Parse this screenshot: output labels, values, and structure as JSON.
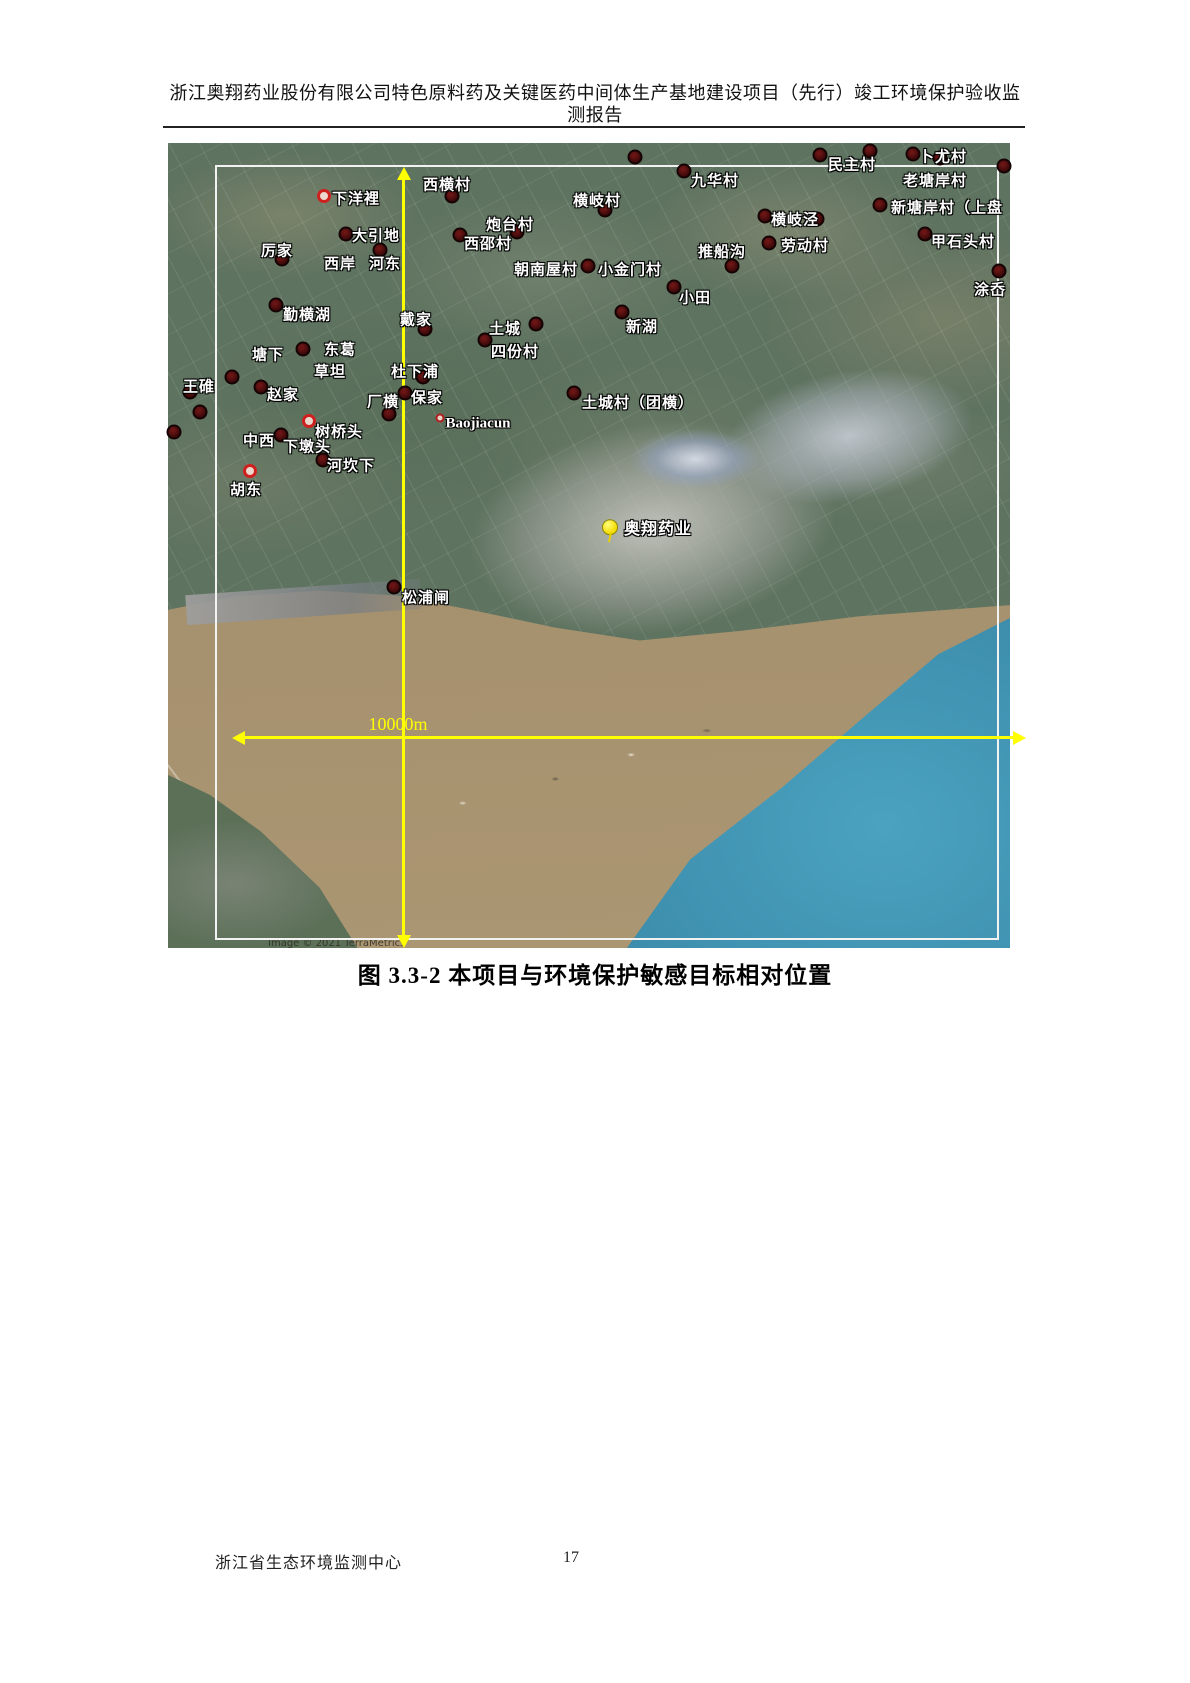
{
  "header": {
    "title_line1": "浙江奥翔药业股份有限公司特色原料药及关键医药中间体生产基地建设项目（先行）竣工环境保护验收监",
    "title_line2": "测报告"
  },
  "figure": {
    "caption": "图 3.3-2  本项目与环境保护敏感目标相对位置",
    "scale_label": "10000m",
    "attribution": "Image © 2021 TerraMetrics",
    "project": {
      "label": "奥翔药业",
      "label_x": 490,
      "label_y": 384,
      "pin_x": 442,
      "pin_y": 385
    },
    "labels": [
      {
        "text": "下洋裡",
        "x": 188,
        "y": 55
      },
      {
        "text": "西横村",
        "x": 279,
        "y": 41
      },
      {
        "text": "厉家",
        "x": 109,
        "y": 107
      },
      {
        "text": "大引地",
        "x": 208,
        "y": 92
      },
      {
        "text": "西岸",
        "x": 172,
        "y": 120
      },
      {
        "text": "河东",
        "x": 217,
        "y": 120
      },
      {
        "text": "炮台村",
        "x": 342,
        "y": 81
      },
      {
        "text": "西邵村",
        "x": 320,
        "y": 100
      },
      {
        "text": "朝南屋村",
        "x": 378,
        "y": 126
      },
      {
        "text": "小金门村",
        "x": 462,
        "y": 126
      },
      {
        "text": "横岐村",
        "x": 429,
        "y": 57
      },
      {
        "text": "九华村",
        "x": 547,
        "y": 37
      },
      {
        "text": "推船沟",
        "x": 554,
        "y": 108
      },
      {
        "text": "横岐泾",
        "x": 627,
        "y": 76
      },
      {
        "text": "劳动村",
        "x": 637,
        "y": 102
      },
      {
        "text": "民主村",
        "x": 684,
        "y": 21
      },
      {
        "text": "卜尤村",
        "x": 775,
        "y": 13
      },
      {
        "text": "老塘岸村",
        "x": 767,
        "y": 37
      },
      {
        "text": "新塘岸村（上盘",
        "x": 779,
        "y": 64
      },
      {
        "text": "甲石头村",
        "x": 795,
        "y": 98
      },
      {
        "text": "涂岙",
        "x": 822,
        "y": 146
      },
      {
        "text": "勤横湖",
        "x": 139,
        "y": 171
      },
      {
        "text": "戴家",
        "x": 248,
        "y": 176
      },
      {
        "text": "东葛",
        "x": 172,
        "y": 206
      },
      {
        "text": "塘下",
        "x": 100,
        "y": 211
      },
      {
        "text": "草坦",
        "x": 162,
        "y": 228
      },
      {
        "text": "杜下浦",
        "x": 247,
        "y": 228
      },
      {
        "text": "土城",
        "x": 337,
        "y": 185
      },
      {
        "text": "四份村",
        "x": 347,
        "y": 208
      },
      {
        "text": "王碓",
        "x": 31,
        "y": 243
      },
      {
        "text": "赵家",
        "x": 115,
        "y": 251
      },
      {
        "text": "厂横",
        "x": 215,
        "y": 258
      },
      {
        "text": "保家",
        "x": 259,
        "y": 254
      },
      {
        "text": "Baojiacun",
        "x": 310,
        "y": 281,
        "latin": true
      },
      {
        "text": "树桥头",
        "x": 171,
        "y": 288
      },
      {
        "text": "中西",
        "x": 91,
        "y": 297
      },
      {
        "text": "下墩头",
        "x": 139,
        "y": 303
      },
      {
        "text": "河坎下",
        "x": 183,
        "y": 322
      },
      {
        "text": "胡东",
        "x": 78,
        "y": 346
      },
      {
        "text": "新湖",
        "x": 474,
        "y": 183
      },
      {
        "text": "小田",
        "x": 527,
        "y": 154
      },
      {
        "text": "土城村（团横）",
        "x": 470,
        "y": 259
      },
      {
        "text": "松浦闸",
        "x": 258,
        "y": 454
      }
    ],
    "markers": [
      {
        "x": 156,
        "y": 53,
        "type": "ring"
      },
      {
        "x": 284,
        "y": 53,
        "type": "dark"
      },
      {
        "x": 114,
        "y": 116,
        "type": "dark"
      },
      {
        "x": 178,
        "y": 91,
        "type": "dark"
      },
      {
        "x": 212,
        "y": 107,
        "type": "dark"
      },
      {
        "x": 349,
        "y": 89,
        "type": "dark"
      },
      {
        "x": 292,
        "y": 92,
        "type": "dark"
      },
      {
        "x": 420,
        "y": 123,
        "type": "dark"
      },
      {
        "x": 437,
        "y": 67,
        "type": "dark"
      },
      {
        "x": 516,
        "y": 28,
        "type": "dark"
      },
      {
        "x": 467,
        "y": 14,
        "type": "dark"
      },
      {
        "x": 564,
        "y": 123,
        "type": "dark"
      },
      {
        "x": 597,
        "y": 73,
        "type": "dark"
      },
      {
        "x": 649,
        "y": 76,
        "type": "dark"
      },
      {
        "x": 601,
        "y": 100,
        "type": "dark"
      },
      {
        "x": 652,
        "y": 12,
        "type": "dark"
      },
      {
        "x": 702,
        "y": 8,
        "type": "dark"
      },
      {
        "x": 745,
        "y": 11,
        "type": "dark"
      },
      {
        "x": 772,
        "y": 15,
        "type": "dark"
      },
      {
        "x": 836,
        "y": 23,
        "type": "dark"
      },
      {
        "x": 712,
        "y": 62,
        "type": "dark"
      },
      {
        "x": 757,
        "y": 91,
        "type": "dark"
      },
      {
        "x": 831,
        "y": 128,
        "type": "dark"
      },
      {
        "x": 108,
        "y": 162,
        "type": "dark"
      },
      {
        "x": 257,
        "y": 186,
        "type": "dark"
      },
      {
        "x": 135,
        "y": 206,
        "type": "dark"
      },
      {
        "x": 255,
        "y": 234,
        "type": "dark"
      },
      {
        "x": 368,
        "y": 181,
        "type": "dark"
      },
      {
        "x": 317,
        "y": 197,
        "type": "dark"
      },
      {
        "x": 64,
        "y": 234,
        "type": "dark"
      },
      {
        "x": 22,
        "y": 249,
        "type": "dark"
      },
      {
        "x": 32,
        "y": 269,
        "type": "dark"
      },
      {
        "x": 6,
        "y": 289,
        "type": "dark"
      },
      {
        "x": 93,
        "y": 244,
        "type": "dark"
      },
      {
        "x": 221,
        "y": 271,
        "type": "dark"
      },
      {
        "x": 237,
        "y": 250,
        "type": "dark"
      },
      {
        "x": 272,
        "y": 275,
        "type": "dot"
      },
      {
        "x": 141,
        "y": 278,
        "type": "ring"
      },
      {
        "x": 113,
        "y": 292,
        "type": "dark"
      },
      {
        "x": 155,
        "y": 317,
        "type": "dark"
      },
      {
        "x": 82,
        "y": 328,
        "type": "ring"
      },
      {
        "x": 454,
        "y": 169,
        "type": "dark"
      },
      {
        "x": 506,
        "y": 144,
        "type": "dark"
      },
      {
        "x": 406,
        "y": 250,
        "type": "dark"
      },
      {
        "x": 226,
        "y": 444,
        "type": "dark"
      }
    ]
  },
  "footer": {
    "organization": "浙江省生态环境监测中心",
    "page_number": "17"
  },
  "colors": {
    "axis_yellow": "#ffff00",
    "marker_dark": "#3b0a0a",
    "marker_ring": "#cf2020",
    "river_brown": "#a18a69",
    "ocean_blue": "#3e8fb0",
    "label_white": "#ffffff"
  }
}
